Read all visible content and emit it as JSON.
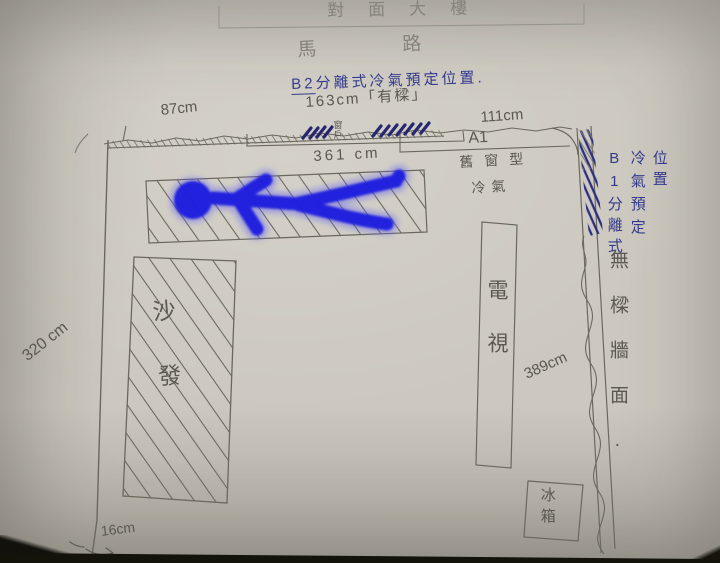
{
  "labels": {
    "building": "對面大樓",
    "road": "馬路",
    "b2_prefix": "B2",
    "b2_note": "分離式冷氣預定位置.",
    "beam_note": "163cm「有樑」",
    "window": "窗戶",
    "a1_code": "A1",
    "a1_type": "舊窗型",
    "a1_ac": "冷氣",
    "b1_col1": "B1分離式",
    "b1_col2": "冷氣預定",
    "b1_col3": "位置",
    "right_wall_note": "無樑牆面.",
    "sofa": "沙發",
    "tv": "電視",
    "fridge": "冰箱"
  },
  "dimensions": {
    "top_left_wall": "87cm",
    "top_right_wall": "111cm",
    "inner_width": "361 cm",
    "left_wall": "320 cm",
    "right_wall": "389cm",
    "bottom_offset": "16cm"
  },
  "colors": {
    "paper": "#ccc8bf",
    "pencil": "#5a584f",
    "blue_ink": "#343a8c",
    "marker_blue": "#1a1adf"
  }
}
